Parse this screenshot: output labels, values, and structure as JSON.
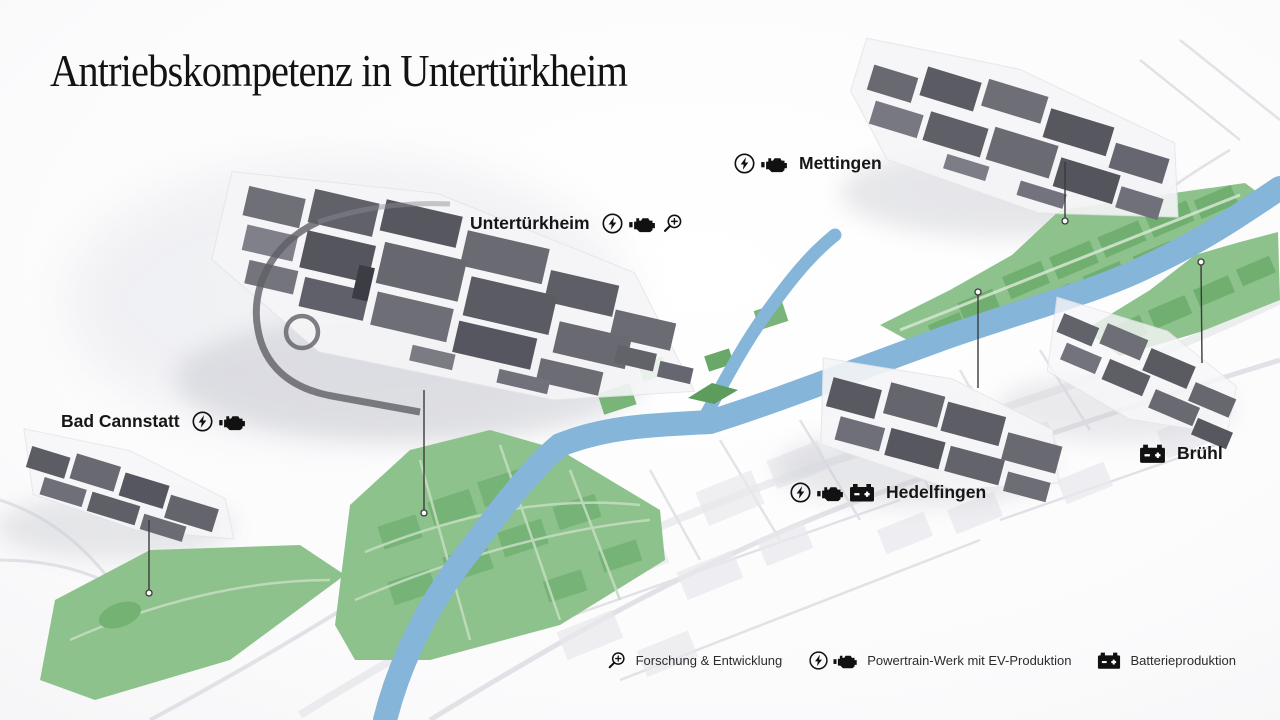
{
  "title": "Antriebskompetenz in Untertürkheim",
  "sites": {
    "mettingen": {
      "name": "Mettingen"
    },
    "untertuerkheim": {
      "name": "Untertürkheim"
    },
    "bad_cannstatt": {
      "name": "Bad Cannstatt"
    },
    "bruehl": {
      "name": "Brühl"
    },
    "hedelfingen": {
      "name": "Hedelfingen"
    }
  },
  "legend": {
    "research": {
      "label": "Forschung & Entwicklung"
    },
    "powertrain": {
      "label": "Powertrain-Werk mit EV-Produktion"
    },
    "battery": {
      "label": "Batterieproduktion"
    }
  },
  "icons": {
    "ev": "ev-lightning-circle-icon",
    "engine": "engine-icon",
    "research": "magnifier-plus-icon",
    "battery": "battery-icon"
  },
  "colors": {
    "river": "#85b5d8",
    "greenspace": "#8ec28c",
    "greenspace_dark": "#6dac6d",
    "building": "#63636b",
    "text": "#1a1a1a"
  }
}
